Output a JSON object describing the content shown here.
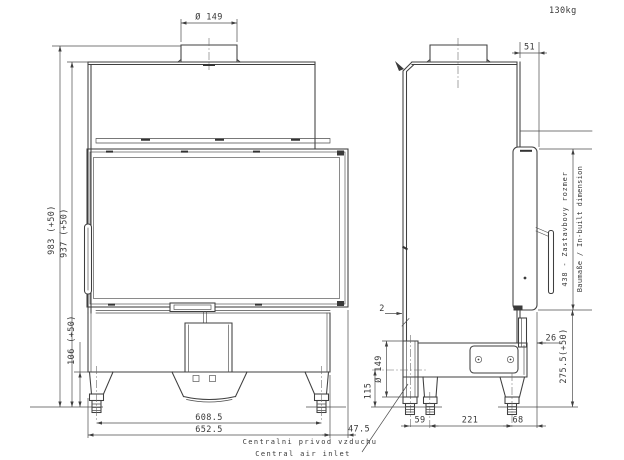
{
  "drawing": {
    "weight_label": "130kg",
    "front_view": {
      "flue_diameter": "Ø 149",
      "overall_height": "983 (+50)",
      "body_height": "937 (+50)",
      "plinth_height": "106 (+50)",
      "foot_span": "608.5",
      "overall_width": "652.5",
      "frame_offset": "47.5"
    },
    "side_view": {
      "flue_back_offset": "51",
      "sheet_gap": "2",
      "inlet_diameter": "Ø 149",
      "inlet_height": "115",
      "frame_overhang": "26",
      "foot_span_front": "59",
      "foot_span_mid": "221",
      "foot_span_rear": "68",
      "inbuilt_depth_primary": "438 - Zastavbovy rozmer",
      "inbuilt_depth_secondary": "Baumaße / In-built dimension",
      "lower_inbuilt_height": "275.5(+50)"
    },
    "notes": {
      "air_inlet_line1": "Centralni privod vzduchu",
      "air_inlet_line2": "Central air inlet"
    }
  }
}
